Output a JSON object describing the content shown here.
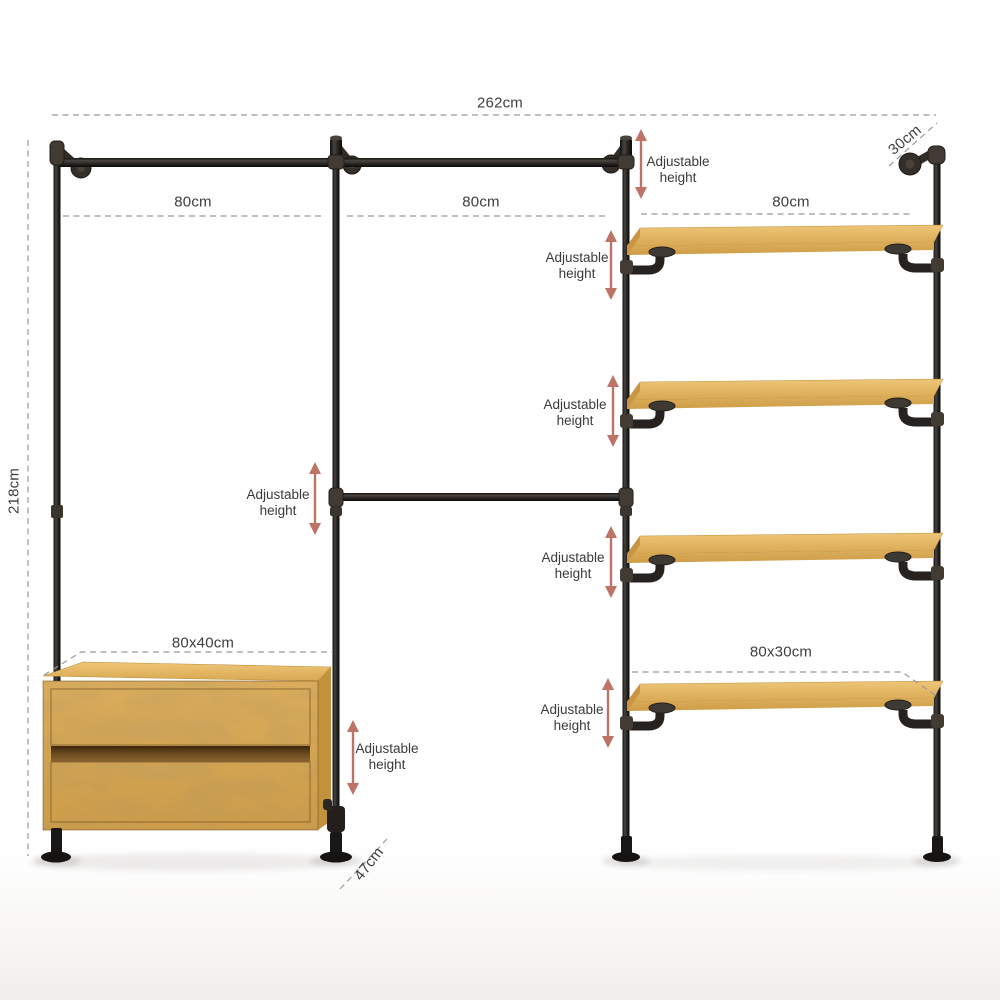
{
  "product": {
    "type": "industrial-pipe-wardrobe-system",
    "bays": 3,
    "shelves_count": 4,
    "drawers_count": 2
  },
  "labels": {
    "total_width": "262cm",
    "top_depth": "30cm",
    "bay1_width": "80cm",
    "bay2_width": "80cm",
    "bay3_width": "80cm",
    "height": "218cm",
    "dresser_size": "80x40cm",
    "shelf_size": "80x30cm",
    "floor_depth": "47cm"
  },
  "adjustable": {
    "line1": "Adjustable",
    "line2": "height"
  },
  "colors": {
    "arrow": "#bd7467",
    "pipe_dark": "#1b1917",
    "fitting": "#453e36",
    "wood": "#d9aa55",
    "wood_top": "#e6bc6c",
    "dash_line": "#999999",
    "text": "#3e3e3e",
    "background": "#ffffff"
  }
}
